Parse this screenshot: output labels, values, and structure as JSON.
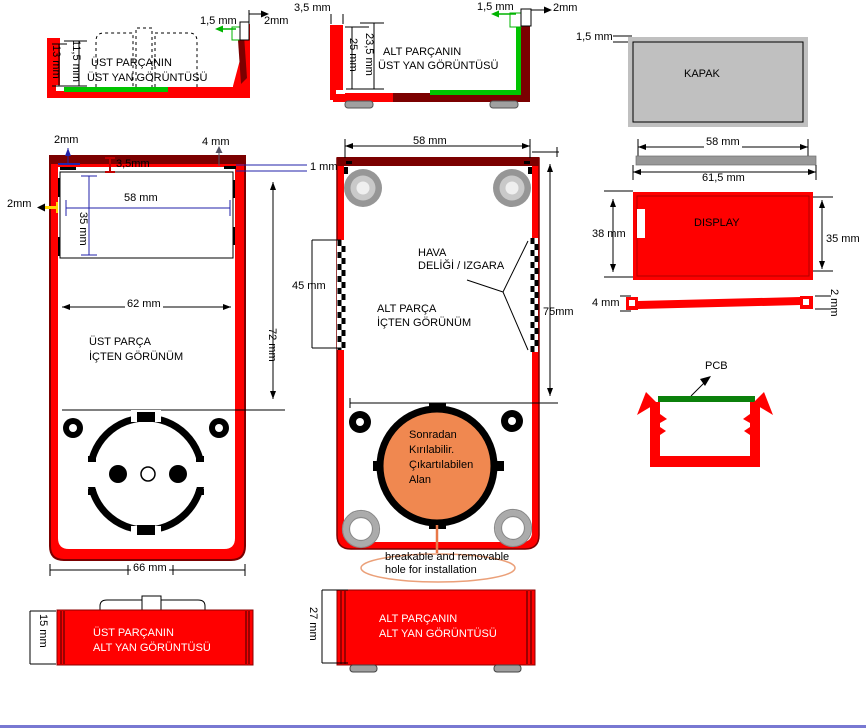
{
  "colors": {
    "part_red": "#FF0000",
    "part_dark_red": "#7B0000",
    "seal_green": "#00C400",
    "pcb_green": "#0B800B",
    "cover_gray": "#C0C0C0",
    "dim_blue": "#2222AA",
    "dim_yellow": "#FFD400",
    "breakout_orange": "#F08850",
    "note_orange": "#E89A70"
  },
  "views": {
    "top_left_side": {
      "title1": "ÜST PARÇANIN",
      "title2": "ÜST YAN GÖRÜNTÜSÜ",
      "dim_wall": "13 mm",
      "dim_inner": "11,5 mm",
      "dim_seal": "1,5 mm",
      "dim_tab": "2mm"
    },
    "top_mid_side": {
      "title1": "ALT PARÇANIN",
      "title2": "ÜST YAN GÖRÜNTÜSÜ",
      "dim_wall_t": "3,5 mm",
      "dim_depth": "25 mm",
      "dim_inner": "23,5 mm",
      "dim_seal": "1,5 mm",
      "dim_tab": "2mm"
    },
    "cover": {
      "title": "KAPAK",
      "dim_thick": "1,5 mm",
      "dim_w": "58 mm",
      "dim_w2": "61,5 mm"
    },
    "display": {
      "title": "DISPLAY",
      "dim_h": "38 mm",
      "dim_h2": "35 mm",
      "dim_end": "4 mm",
      "dim_thick": "2 mm"
    },
    "pcb": {
      "label": "PCB"
    },
    "upper_inner": {
      "title1": "ÜST PARÇA",
      "title2": "İÇTEN GÖRÜNÜM",
      "dim_top": "2mm",
      "dim_corner": "4 mm",
      "dim_gap": "3,5mm",
      "dim_edge": "1 mm",
      "dim_left": "2mm",
      "dim_win_w": "58 mm",
      "dim_win_h": "35 mm",
      "dim_inner_w": "62 mm",
      "dim_h": "72 mm",
      "dim_w": "66 mm"
    },
    "lower_inner": {
      "title1": "ALT PARÇA",
      "title2": "İÇTEN GÖRÜNÜM",
      "dim_w": "58 mm",
      "dim_vent": "45 mm",
      "dim_h": "75mm",
      "vent1": "HAVA",
      "vent2": "DELİĞİ / IZGARA",
      "hole1": "Sonradan",
      "hole2": "Kırılabilir.",
      "hole3": "Çıkartılabilen",
      "hole4": "Alan",
      "note1": "breakable and removable",
      "note2": "hole for installation"
    },
    "bottom_left_side": {
      "title1": "ÜST PARÇANIN",
      "title2": "ALT YAN GÖRÜNTÜSÜ",
      "dim_h": "15 mm"
    },
    "bottom_mid_side": {
      "title1": "ALT PARÇANIN",
      "title2": "ALT YAN GÖRÜNTÜSÜ",
      "dim_h": "27 mm"
    }
  }
}
